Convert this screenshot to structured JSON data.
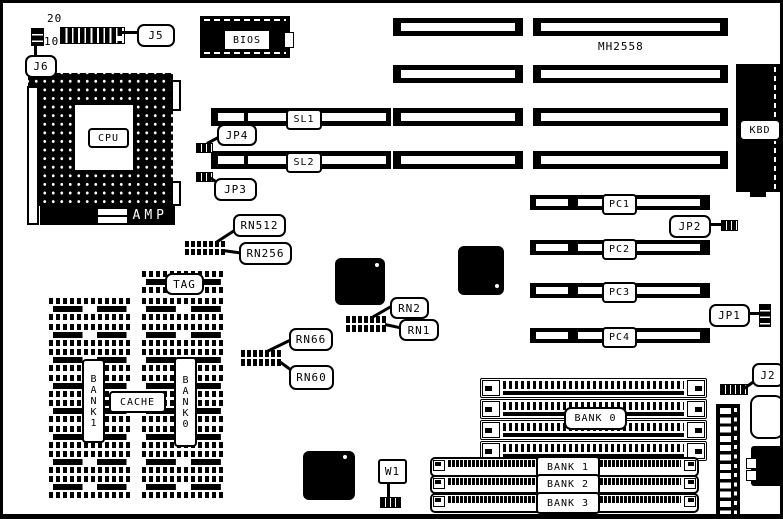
{
  "board": {
    "part_number": "MH2558",
    "header_pin_top": "20",
    "header_pin_bottom": "10",
    "chips": {
      "bios": "BIOS",
      "cpu": "CPU",
      "amp": "AMP",
      "kbd": "KBD"
    },
    "callouts": {
      "j5": "J5",
      "j6": "J6",
      "jp4": "JP4",
      "jp3": "JP3",
      "jp2": "JP2",
      "jp1": "JP1",
      "j2": "J2",
      "w1": "W1",
      "rn512": "RN512",
      "rn256": "RN256",
      "rn2": "RN2",
      "rn1": "RN1",
      "rn66": "RN66",
      "rn60": "RN60",
      "tag": "TAG"
    },
    "slots": {
      "sl1": "SL1",
      "sl2": "SL2",
      "pc1": "PC1",
      "pc2": "PC2",
      "pc3": "PC3",
      "pc4": "PC4"
    },
    "cache": {
      "label": "CACHE",
      "bank1_vertical": "BANK1",
      "bank0_vertical": "BANK0"
    },
    "memory_banks": {
      "bank0": "BANK 0",
      "bank1": "BANK 1",
      "bank2": "BANK 2",
      "bank3": "BANK 3"
    },
    "colors": {
      "foreground": "#000000",
      "background": "#ffffff"
    }
  }
}
